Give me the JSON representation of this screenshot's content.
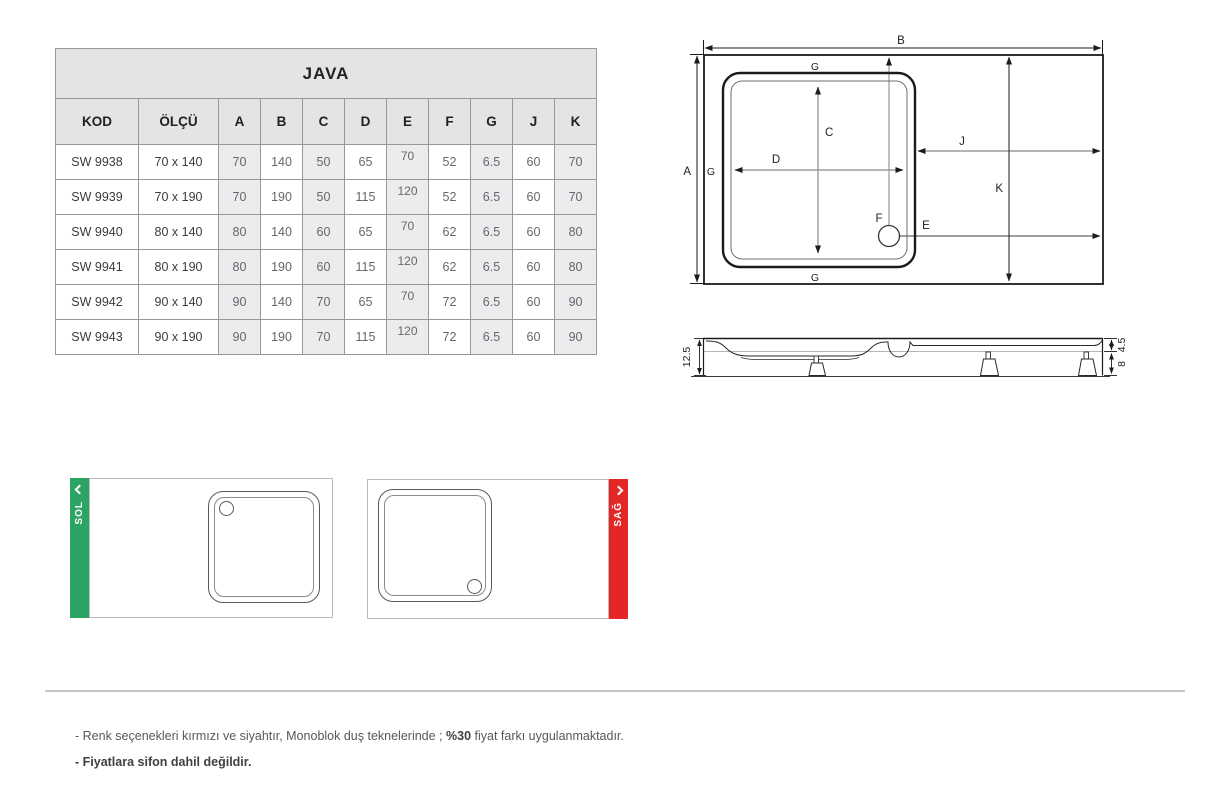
{
  "table": {
    "title": "JAVA",
    "columns": [
      "KOD",
      "ÖLÇÜ",
      "A",
      "B",
      "C",
      "D",
      "E",
      "F",
      "G",
      "J",
      "K"
    ],
    "rows": [
      [
        "SW 9938",
        "70 x 140",
        "70",
        "140",
        "50",
        "65",
        "70",
        "52",
        "6.5",
        "60",
        "70"
      ],
      [
        "SW 9939",
        "70 x 190",
        "70",
        "190",
        "50",
        "115",
        "120",
        "52",
        "6.5",
        "60",
        "70"
      ],
      [
        "SW 9940",
        "80 x 140",
        "80",
        "140",
        "60",
        "65",
        "70",
        "62",
        "6.5",
        "60",
        "80"
      ],
      [
        "SW 9941",
        "80 x 190",
        "80",
        "190",
        "60",
        "115",
        "120",
        "62",
        "6.5",
        "60",
        "80"
      ],
      [
        "SW 9942",
        "90 x 140",
        "90",
        "140",
        "70",
        "65",
        "70",
        "72",
        "6.5",
        "60",
        "90"
      ],
      [
        "SW 9943",
        "90 x 190",
        "90",
        "190",
        "70",
        "115",
        "120",
        "72",
        "6.5",
        "60",
        "90"
      ]
    ]
  },
  "diagram_top": {
    "a": "A",
    "b": "B",
    "c": "C",
    "d": "D",
    "e": "E",
    "f": "F",
    "j": "J",
    "k": "K",
    "g_top": "G",
    "g_left": "G",
    "g_bottom": "G"
  },
  "diagram_side": {
    "height_total": "12.5",
    "height_top": "4.5",
    "height_bottom": "8"
  },
  "thumbnails": {
    "left": {
      "label": "SOL",
      "icon": "chevron-left",
      "color": "#2ba465"
    },
    "right": {
      "label": "SAĞ",
      "icon": "chevron-right",
      "color": "#e42627"
    }
  },
  "footer": {
    "note1_prefix": "- Renk seçenekleri kırmızı ve siyahtır, Monoblok duş teknelerinde ; ",
    "note1_bold": "%30",
    "note1_suffix": " fiyat farkı uygulanmaktadır.",
    "note2": "- Fiyatlara sifon dahil değildir."
  }
}
